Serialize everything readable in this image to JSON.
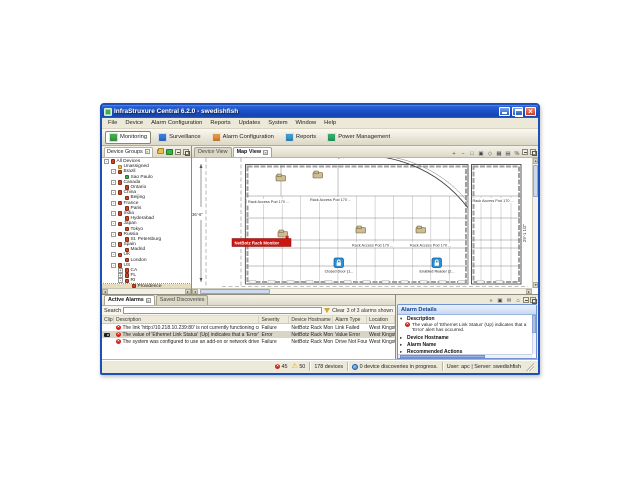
{
  "window": {
    "title": "InfraStruxure Central 6.2.0 - swedishfish",
    "menus": [
      "File",
      "Device",
      "Alarm Configuration",
      "Reports",
      "Updates",
      "System",
      "Window",
      "Help"
    ],
    "toolbar_buttons": [
      {
        "label": "Monitoring",
        "color": "#3fae49",
        "pressed": true
      },
      {
        "label": "Surveillance",
        "color": "#3b7dd8",
        "pressed": false
      },
      {
        "label": "Alarm Configuration",
        "color": "#e8963d",
        "pressed": false
      },
      {
        "label": "Reports",
        "color": "#3b9dd8",
        "pressed": false
      },
      {
        "label": "Power Management",
        "color": "#2fae69",
        "pressed": false
      }
    ]
  },
  "device_groups": {
    "title": "Device Groups",
    "header_icons": [
      "add-group",
      "show-devices"
    ],
    "items": [
      {
        "label": "All Devices",
        "level": 0,
        "ex": "-",
        "icon": "red"
      },
      {
        "label": "Unassigned",
        "level": 1,
        "ex": "",
        "icon": "folder"
      },
      {
        "label": "Brazil",
        "level": 1,
        "ex": "-",
        "icon": "red"
      },
      {
        "label": "Sao Paulo",
        "level": 2,
        "ex": "",
        "icon": "green"
      },
      {
        "label": "Canada",
        "level": 1,
        "ex": "-",
        "icon": "red"
      },
      {
        "label": "Ontario",
        "level": 2,
        "ex": "",
        "icon": "red"
      },
      {
        "label": "China",
        "level": 1,
        "ex": "-",
        "icon": "red"
      },
      {
        "label": "Beijing",
        "level": 2,
        "ex": "",
        "icon": "red"
      },
      {
        "label": "France",
        "level": 1,
        "ex": "-",
        "icon": "red"
      },
      {
        "label": "Paris",
        "level": 2,
        "ex": "",
        "icon": "red"
      },
      {
        "label": "India",
        "level": 1,
        "ex": "-",
        "icon": "red"
      },
      {
        "label": "Hyderabad",
        "level": 2,
        "ex": "",
        "icon": "red"
      },
      {
        "label": "Japan",
        "level": 1,
        "ex": "-",
        "icon": "red"
      },
      {
        "label": "Tokyo",
        "level": 2,
        "ex": "",
        "icon": "red"
      },
      {
        "label": "Russia",
        "level": 1,
        "ex": "-",
        "icon": "red"
      },
      {
        "label": "St. Petersburg",
        "level": 2,
        "ex": "",
        "icon": "red"
      },
      {
        "label": "Spain",
        "level": 1,
        "ex": "-",
        "icon": "red"
      },
      {
        "label": "Madrid",
        "level": 2,
        "ex": "",
        "icon": "red"
      },
      {
        "label": "UK",
        "level": 1,
        "ex": "-",
        "icon": "red"
      },
      {
        "label": "London",
        "level": 2,
        "ex": "",
        "icon": "red"
      },
      {
        "label": "US",
        "level": 1,
        "ex": "-",
        "icon": "red"
      },
      {
        "label": "CA",
        "level": 2,
        "ex": "+",
        "icon": "red"
      },
      {
        "label": "FL",
        "level": 2,
        "ex": "+",
        "icon": "red"
      },
      {
        "label": "RI",
        "level": 2,
        "ex": "-",
        "icon": "red"
      },
      {
        "label": "Providence",
        "level": 3,
        "ex": "",
        "icon": "red",
        "selected": true
      }
    ]
  },
  "map_panel": {
    "tabs": [
      {
        "label": "Device View"
      },
      {
        "label": "Map View"
      }
    ],
    "active_tab": "Map View",
    "toolbar_icons": [
      "zoom-in",
      "zoom-out",
      "zoom-fit",
      "select",
      "pan",
      "grid",
      "layers",
      "settings"
    ],
    "map": {
      "rack": "Rack Access Pod 170 ...",
      "dim_left": "36'-6\"",
      "dim_right": "29'-1 1/2\"",
      "badge": "NetBotz Rack Monitor",
      "door": "Closed Door (1...",
      "reader": "Enabled Reader (2..."
    }
  },
  "alarms_panel": {
    "tabs": [
      {
        "label": "Active Alarms"
      },
      {
        "label": "Saved Discoveries"
      }
    ],
    "active_tab": "Active Alarms",
    "search_label": "Search",
    "clear_label": "Clear",
    "count_text": "3 of 3 alarms shown",
    "columns": [
      "Clip",
      "Description",
      "Severity",
      "Device Hostname",
      "Alarm Type",
      "Location"
    ],
    "rows": [
      {
        "clip": false,
        "description": "The link 'http://10.218.10.239:80' is not currently functioning corre...",
        "severity": "Failure",
        "hostname": "NetBotz Rack Monitor 550",
        "type": "Link Failed",
        "location": "West Kingston",
        "selected": false
      },
      {
        "clip": true,
        "description": "The value of 'Ethernet Link Status' (Up) indicates that a 'Error' alert ...",
        "severity": "Error",
        "hostname": "NetBotz Rack Monitor 550",
        "type": "Value Error",
        "location": "West Kingston",
        "selected": true
      },
      {
        "clip": false,
        "description": "The system was configured to use an add-on or network drive for s...",
        "severity": "Failure",
        "hostname": "NetBotz Rack Monitor 550",
        "type": "Drive Not Found",
        "location": "West Kingston",
        "selected": false
      }
    ]
  },
  "alarm_details": {
    "title": "Alarm Details",
    "toolbar_icons": [
      "double-chevron",
      "image",
      "mail",
      "home"
    ],
    "sections": [
      {
        "label": "Description",
        "expanded": true,
        "content": "The value of 'Ethernet Link Status' (Up) indicates that a 'Error' alert has occurred."
      },
      {
        "label": "Device Hostname",
        "expanded": false
      },
      {
        "label": "Alarm Name",
        "expanded": false
      },
      {
        "label": "Recommended Actions",
        "expanded": false
      }
    ]
  },
  "status_bar": {
    "critical_count": "45",
    "warning_count": "50",
    "devices_text": "178 devices",
    "discovery_text": "0 device discoveries in progress.",
    "user_text": "User: apc | Server: swedishfish"
  }
}
